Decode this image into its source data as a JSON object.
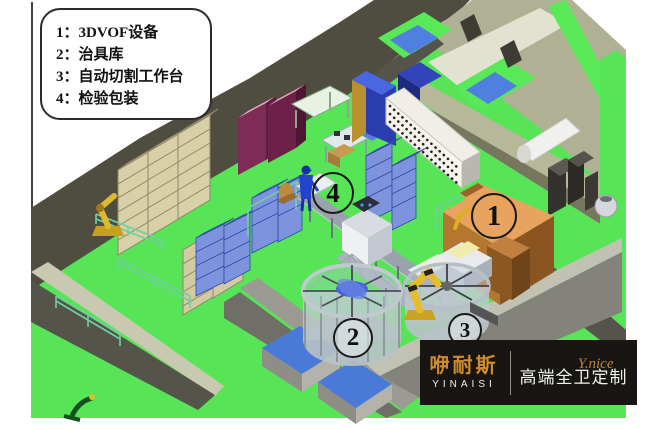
{
  "legend": {
    "items": [
      {
        "text": "1：3DVOF设备"
      },
      {
        "text": "2：治具库"
      },
      {
        "text": "3：自动切割工作台"
      },
      {
        "text": "4：检验包装"
      }
    ]
  },
  "markers": [
    {
      "label": "1"
    },
    {
      "label": "2"
    },
    {
      "label": "3"
    },
    {
      "label": "4"
    }
  ],
  "logo": {
    "brand_cn": "咿耐斯",
    "brand_en": "YINAISI",
    "script": "Y.nice",
    "tagline": "高端全卫定制"
  },
  "colors": {
    "floor_green": "#57e457",
    "wall_dark": "#4e4d40",
    "wall_khaki": "#b0b094",
    "machine_orange_top": "#e8a35e",
    "equipment_blue": "#7d93de",
    "cabinet_pink": "#f0a8cc",
    "cabinet_maroon": "#7e2c56",
    "shelf_tan": "#d8d0a6",
    "robot_yellow": "#e0b830",
    "logo_gold": "#cf8c2e",
    "logo_bg": "#181512"
  }
}
